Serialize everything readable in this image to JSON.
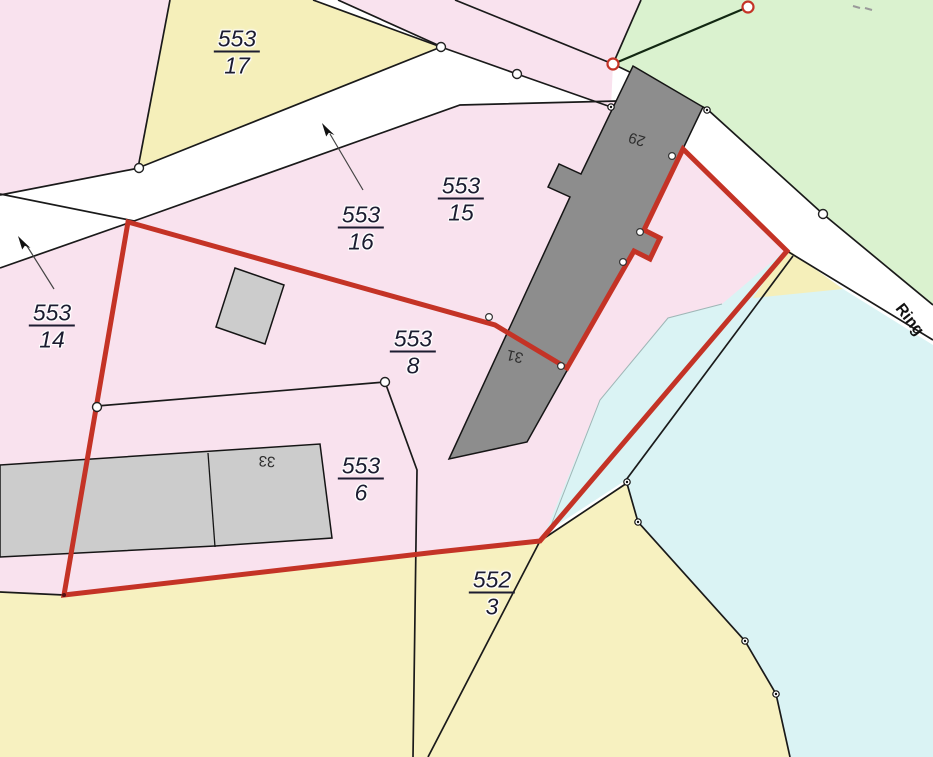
{
  "map": {
    "title": "cadastral-parcel-map",
    "canvas": {
      "width": 933,
      "height": 757,
      "background": "#ffffff"
    },
    "palette": {
      "parcel_pink": "#f9e2ee",
      "parcel_yellow": "#f5efba",
      "parcel_yellow_light": "#f7f1c0",
      "parcel_green": "#daf2cf",
      "water_blue": "#daf3f4",
      "building_dark": "#8d8d8d",
      "building_light": "#cccccc",
      "boundary_black": "#1a1a1a",
      "selection_red": "#c43326",
      "label_ink": "#1c1c30"
    },
    "regions": [
      {
        "name": "parcel-pink-northwest",
        "color": "#f9e2ee",
        "points": [
          [
            0,
            0
          ],
          [
            170,
            0
          ],
          [
            139,
            168
          ],
          [
            0,
            195
          ]
        ]
      },
      {
        "name": "parcel-553-17",
        "color": "#f5efba",
        "points": [
          [
            170,
            0
          ],
          [
            313,
            0
          ],
          [
            441,
            47
          ],
          [
            138,
            168
          ]
        ]
      },
      {
        "name": "parcel-pink-top-triangle",
        "color": "#f9e2ee",
        "points": [
          [
            338,
            0
          ],
          [
            641,
            0
          ],
          [
            613,
            64
          ],
          [
            611,
            107
          ],
          [
            517,
            74
          ],
          [
            440,
            46
          ]
        ]
      },
      {
        "name": "parcel-green-northeast",
        "color": "#daf2cf",
        "points": [
          [
            641,
            0
          ],
          [
            933,
            0
          ],
          [
            933,
            305
          ],
          [
            823,
            214
          ],
          [
            707,
            109
          ],
          [
            613,
            64
          ]
        ]
      },
      {
        "name": "parcel-pink-main",
        "color": "#f9e2ee",
        "points": [
          [
            0,
            268
          ],
          [
            134,
            221
          ],
          [
            460,
            105
          ],
          [
            618,
            101
          ],
          [
            633,
            66
          ],
          [
            703,
            107
          ],
          [
            683,
            149
          ],
          [
            787,
            251
          ],
          [
            540,
            541
          ],
          [
            437,
            552
          ],
          [
            64,
            595
          ],
          [
            0,
            591
          ]
        ]
      },
      {
        "name": "parcel-552-3",
        "color": "#f7f1c0",
        "points": [
          [
            0,
            591
          ],
          [
            64,
            595
          ],
          [
            540,
            541
          ],
          [
            627,
            483
          ],
          [
            638,
            522
          ],
          [
            745,
            641
          ],
          [
            776,
            694
          ],
          [
            790,
            757
          ],
          [
            0,
            757
          ]
        ]
      },
      {
        "name": "water-area",
        "color": "#daf3f4",
        "points": [
          [
            545,
            533
          ],
          [
            600,
            400
          ],
          [
            668,
            318
          ],
          [
            722,
            304
          ],
          [
            787,
            249
          ],
          [
            843,
            289
          ],
          [
            933,
            345
          ],
          [
            933,
            757
          ],
          [
            790,
            757
          ],
          [
            776,
            694
          ],
          [
            745,
            641
          ],
          [
            638,
            522
          ],
          [
            626,
            480
          ]
        ]
      },
      {
        "name": "parcel-yellow-wedge",
        "color": "#f5efba",
        "points": [
          [
            787,
            249
          ],
          [
            843,
            289
          ],
          [
            753,
            298
          ]
        ]
      }
    ],
    "boundary_lines": [
      {
        "name": "road-edge-a",
        "points": [
          [
            0,
            195
          ],
          [
            139,
            168
          ]
        ]
      },
      {
        "name": "road-inner-line",
        "points": [
          [
            0,
            194
          ],
          [
            134,
            221
          ]
        ]
      },
      {
        "name": "road-edge-b",
        "points": [
          [
            0,
            268
          ],
          [
            134,
            221
          ]
        ]
      },
      {
        "name": "parcel-553-17-west-edge",
        "points": [
          [
            138,
            168
          ],
          [
            170,
            0
          ]
        ]
      },
      {
        "name": "road-top-edge-ne",
        "points": [
          [
            313,
            0
          ],
          [
            441,
            47
          ]
        ]
      },
      {
        "name": "parcel-553-17-south-edge",
        "points": [
          [
            441,
            47
          ],
          [
            138,
            168
          ]
        ]
      },
      {
        "name": "road-chain-edge",
        "points": [
          [
            441,
            47
          ],
          [
            517,
            74
          ],
          [
            611,
            107
          ]
        ]
      },
      {
        "name": "triangle-west-edge",
        "points": [
          [
            338,
            0
          ],
          [
            440,
            46
          ]
        ]
      },
      {
        "name": "triangle-inner-line",
        "points": [
          [
            455,
            0
          ],
          [
            613,
            64
          ]
        ]
      },
      {
        "name": "triangle-east-edge",
        "points": [
          [
            641,
            0
          ],
          [
            613,
            64
          ]
        ]
      },
      {
        "name": "green-survey-line",
        "color": "#122812",
        "width": 2.2,
        "points": [
          [
            613,
            64
          ],
          [
            748,
            7
          ]
        ]
      },
      {
        "name": "ring-road-northeast-edge",
        "points": [
          [
            613,
            64
          ],
          [
            707,
            109
          ],
          [
            823,
            214
          ],
          [
            933,
            305
          ]
        ]
      },
      {
        "name": "ring-road-southwest-edge",
        "points": [
          [
            683,
            149
          ],
          [
            787,
            251
          ],
          [
            933,
            340
          ]
        ]
      },
      {
        "name": "road-south-edge",
        "points": [
          [
            134,
            221
          ],
          [
            460,
            105
          ],
          [
            618,
            101
          ]
        ]
      },
      {
        "name": "west-parcel-line",
        "points": [
          [
            128,
            222
          ],
          [
            64,
            595
          ]
        ]
      },
      {
        "name": "south-parcel-line",
        "points": [
          [
            0,
            592
          ],
          [
            64,
            595
          ],
          [
            540,
            541
          ]
        ]
      },
      {
        "name": "parcel-553-6-boundary",
        "points": [
          [
            97,
            406
          ],
          [
            385,
            382
          ],
          [
            417,
            470
          ],
          [
            413,
            757
          ]
        ]
      },
      {
        "name": "parcel-552-3-inner-line",
        "points": [
          [
            540,
            541
          ],
          [
            428,
            757
          ]
        ]
      },
      {
        "name": "yellow-blue-link-line",
        "points": [
          [
            540,
            541
          ],
          [
            627,
            483
          ]
        ]
      },
      {
        "name": "water-inner-line",
        "points": [
          [
            793,
            256
          ],
          [
            626,
            480
          ]
        ]
      },
      {
        "name": "water-west-chain",
        "points": [
          [
            626,
            480
          ],
          [
            638,
            522
          ],
          [
            745,
            641
          ],
          [
            776,
            694
          ],
          [
            790,
            757
          ]
        ]
      },
      {
        "name": "pink-water-faint-edge",
        "color": "#9fb6b6",
        "width": 1,
        "points": [
          [
            550,
            528
          ],
          [
            600,
            400
          ],
          [
            668,
            318
          ],
          [
            722,
            304
          ]
        ]
      },
      {
        "name": "tick-mark-1",
        "color": "#9a9a9a",
        "width": 2,
        "points": [
          [
            853,
            6
          ],
          [
            860,
            8
          ]
        ]
      },
      {
        "name": "tick-mark-2",
        "color": "#9a9a9a",
        "width": 2,
        "points": [
          [
            865,
            8
          ],
          [
            872,
            10
          ]
        ]
      }
    ],
    "buildings": [
      {
        "name": "building-29-31",
        "color": "#8d8d8d",
        "points": [
          [
            633,
            66
          ],
          [
            703,
            107
          ],
          [
            644,
            230
          ],
          [
            660,
            238
          ],
          [
            650,
            259
          ],
          [
            634,
            251
          ],
          [
            527,
            442
          ],
          [
            449,
            459
          ],
          [
            570,
            197
          ],
          [
            548,
            187
          ],
          [
            559,
            164
          ],
          [
            581,
            174
          ]
        ]
      },
      {
        "name": "building-small-shed",
        "color": "#cccccc",
        "points": [
          [
            235,
            268
          ],
          [
            284,
            285
          ],
          [
            265,
            344
          ],
          [
            216,
            327
          ]
        ]
      },
      {
        "name": "building-33",
        "color": "#cccccc",
        "points": [
          [
            0,
            465
          ],
          [
            320,
            444
          ],
          [
            332,
            538
          ],
          [
            215,
            546
          ],
          [
            0,
            557
          ]
        ],
        "dividers": [
          [
            [
              208,
              453
            ],
            [
              215,
              547
            ]
          ]
        ]
      }
    ],
    "selection": {
      "name": "selected-parcel-boundary",
      "color": "#c43326",
      "width": 5,
      "points": [
        [
          128,
          222
        ],
        [
          495,
          325
        ],
        [
          567,
          368
        ],
        [
          634,
          251
        ],
        [
          650,
          259
        ],
        [
          660,
          238
        ],
        [
          644,
          230
        ],
        [
          683,
          149
        ],
        [
          787,
          251
        ],
        [
          540,
          541
        ],
        [
          437,
          552
        ],
        [
          64,
          595
        ]
      ]
    },
    "points": [
      {
        "name": "survey-point",
        "type": "road",
        "x": 139,
        "y": 168
      },
      {
        "name": "survey-point",
        "type": "road",
        "x": 441,
        "y": 47
      },
      {
        "name": "survey-point",
        "type": "road",
        "x": 517,
        "y": 74
      },
      {
        "name": "survey-point",
        "type": "road",
        "x": 823,
        "y": 214
      },
      {
        "name": "survey-point",
        "type": "road",
        "x": 385,
        "y": 382
      },
      {
        "name": "survey-point",
        "type": "road",
        "x": 97,
        "y": 407
      },
      {
        "name": "control-point-red",
        "type": "red",
        "x": 613,
        "y": 64
      },
      {
        "name": "control-point-red",
        "type": "red",
        "x": 748,
        "y": 7
      },
      {
        "name": "boundary-point",
        "type": "dark",
        "x": 611,
        "y": 107
      },
      {
        "name": "boundary-point",
        "type": "dark",
        "x": 707,
        "y": 110
      },
      {
        "name": "boundary-point",
        "type": "dark",
        "x": 627,
        "y": 482
      },
      {
        "name": "boundary-point",
        "type": "dark",
        "x": 638,
        "y": 522
      },
      {
        "name": "boundary-point",
        "type": "dark",
        "x": 745,
        "y": 641
      },
      {
        "name": "boundary-point",
        "type": "dark",
        "x": 776,
        "y": 694
      },
      {
        "name": "wall-point",
        "type": "wall",
        "x": 489,
        "y": 317
      },
      {
        "name": "wall-point",
        "type": "wall",
        "x": 561,
        "y": 366
      },
      {
        "name": "wall-point",
        "type": "wall",
        "x": 623,
        "y": 262
      },
      {
        "name": "wall-point",
        "type": "wall",
        "x": 640,
        "y": 232
      },
      {
        "name": "wall-point",
        "type": "wall",
        "x": 672,
        "y": 156
      },
      {
        "name": "corner-point",
        "type": "tiny",
        "x": 64,
        "y": 595
      }
    ],
    "arrows": [
      {
        "name": "label-arrow-553-16",
        "tip": [
          322,
          123
        ],
        "line": [
          [
            330,
            134
          ],
          [
            363,
            190
          ]
        ]
      },
      {
        "name": "label-arrow-553-14",
        "tip": [
          18,
          236
        ],
        "line": [
          [
            27,
            246
          ],
          [
            54,
            289
          ]
        ]
      }
    ],
    "parcel_labels": [
      {
        "name": "parcel-label-553-17",
        "num": "553",
        "den": "17",
        "x": 237,
        "y": 52
      },
      {
        "name": "parcel-label-553-16",
        "num": "553",
        "den": "16",
        "x": 361,
        "y": 228
      },
      {
        "name": "parcel-label-553-15",
        "num": "553",
        "den": "15",
        "x": 461,
        "y": 199
      },
      {
        "name": "parcel-label-553-14",
        "num": "553",
        "den": "14",
        "x": 52,
        "y": 326
      },
      {
        "name": "parcel-label-553-8",
        "num": "553",
        "den": "8",
        "x": 413,
        "y": 352
      },
      {
        "name": "parcel-label-553-6",
        "num": "553",
        "den": "6",
        "x": 361,
        "y": 479
      },
      {
        "name": "parcel-label-552-3",
        "num": "552",
        "den": "3",
        "x": 492,
        "y": 593
      }
    ],
    "house_numbers": [
      {
        "name": "house-number-29",
        "text": "29",
        "x": 637,
        "y": 139,
        "rot": 197
      },
      {
        "name": "house-number-31",
        "text": "31",
        "x": 515,
        "y": 356,
        "rot": 193
      },
      {
        "name": "house-number-33",
        "text": "33",
        "x": 267,
        "y": 461,
        "rot": 184
      }
    ],
    "street_label": {
      "name": "street-label-ring",
      "text": "Ring",
      "x": 909,
      "y": 320,
      "rot": 52
    }
  }
}
